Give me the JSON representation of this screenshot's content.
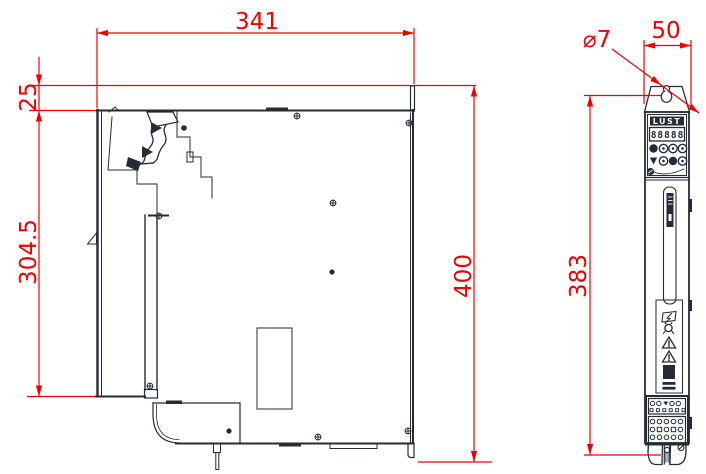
{
  "colors": {
    "line": "#262b34",
    "dimension": "#f20000",
    "background": "#ffffff"
  },
  "dimensions": {
    "overall_width": "341",
    "top_tab_offset": "25",
    "mounting_plate_height": "304.5",
    "overall_height": "400",
    "hole_diameter": "⌀7",
    "front_width": "50",
    "mounting_hole_spacing": "383"
  },
  "front_view": {
    "logo_text": "LUST",
    "display_text": "88888"
  }
}
